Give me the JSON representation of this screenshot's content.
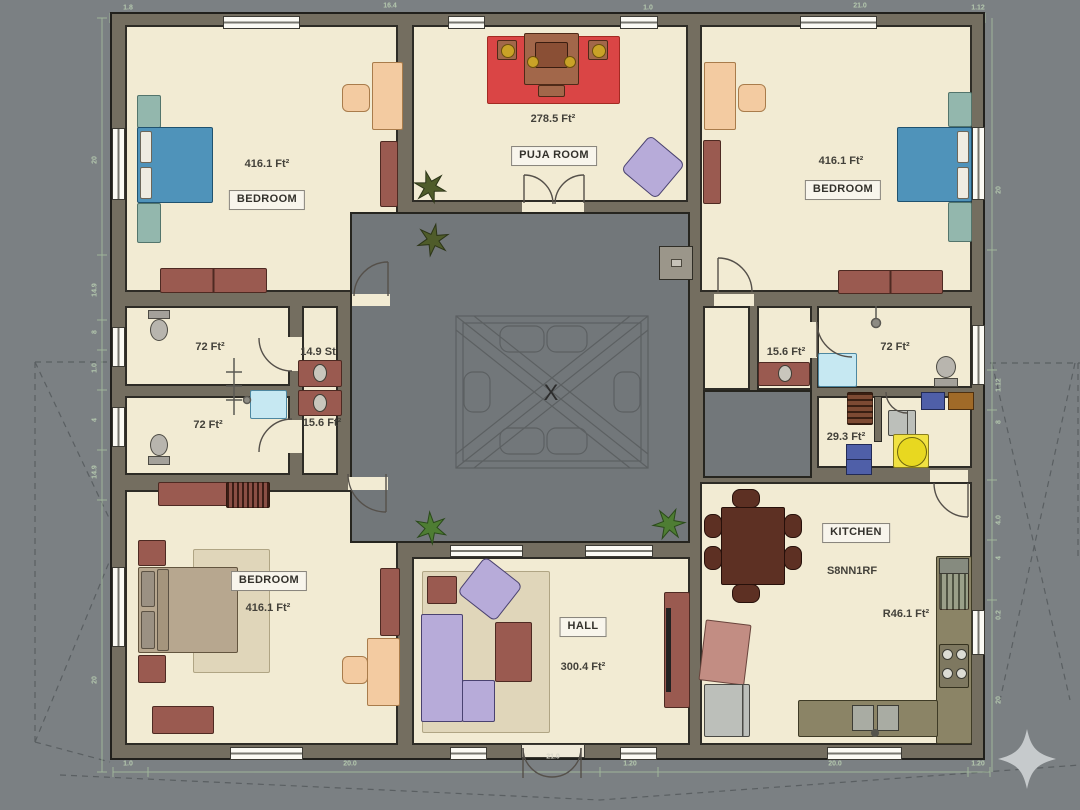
{
  "plan": {
    "rooms": {
      "bedroom_tl": {
        "label": "BEDROOM",
        "area": "416.1 Ft²"
      },
      "puja": {
        "label": "PUJA ROOM",
        "area": "278.5 Ft²"
      },
      "bedroom_tr": {
        "label": "BEDROOM",
        "area": "416.1 Ft²"
      },
      "bath_l1": {
        "area": "72 Ft²"
      },
      "bath_l2": {
        "area": "72 Ft²"
      },
      "wc_l1": {
        "area": "14.9 St"
      },
      "wc_l2": {
        "area": "15.6 Ft²"
      },
      "wc_r": {
        "area": "15.6 Ft²"
      },
      "bath_r": {
        "area": "72 Ft²"
      },
      "store": {
        "area": "29.3 Ft²"
      },
      "bedroom_bl": {
        "label": "BEDROOM",
        "area": "416.1 Ft²"
      },
      "hall": {
        "label": "HALL",
        "area": "300.4 Ft²"
      },
      "kitchen": {
        "label": "KITCHEN",
        "note": "S8NN1RF",
        "area": "R46.1 Ft²"
      }
    },
    "courtyard_marker": "X",
    "entrance_dim": "21.0",
    "dims": {
      "top": [
        "1.8",
        "16.4",
        "1.0",
        "21.0",
        "1.12"
      ],
      "bottom": [
        "1.0",
        "20.0",
        "1.20",
        "20.0",
        "1.20"
      ],
      "left": [
        "20",
        "14.9",
        "8",
        "1.0",
        "4",
        "14.9",
        "20"
      ],
      "right": [
        "20",
        "1.12",
        "8",
        "4.0",
        "4",
        "0.2",
        "20"
      ]
    },
    "colors": {
      "background": "#7b8083",
      "wall": "#746e60",
      "floor": "#f2ebd3",
      "courtyard": "#72777a",
      "bed_blue": "#4f93ba",
      "accent_red": "#9a5a50",
      "mat_red": "#da4545",
      "sofa_purple": "#b7abd9",
      "desk_peach": "#f3cba1",
      "dim_green": "#b4c8ae",
      "counter_khaki": "#8b8466",
      "table_yellow": "#f1e242"
    }
  }
}
